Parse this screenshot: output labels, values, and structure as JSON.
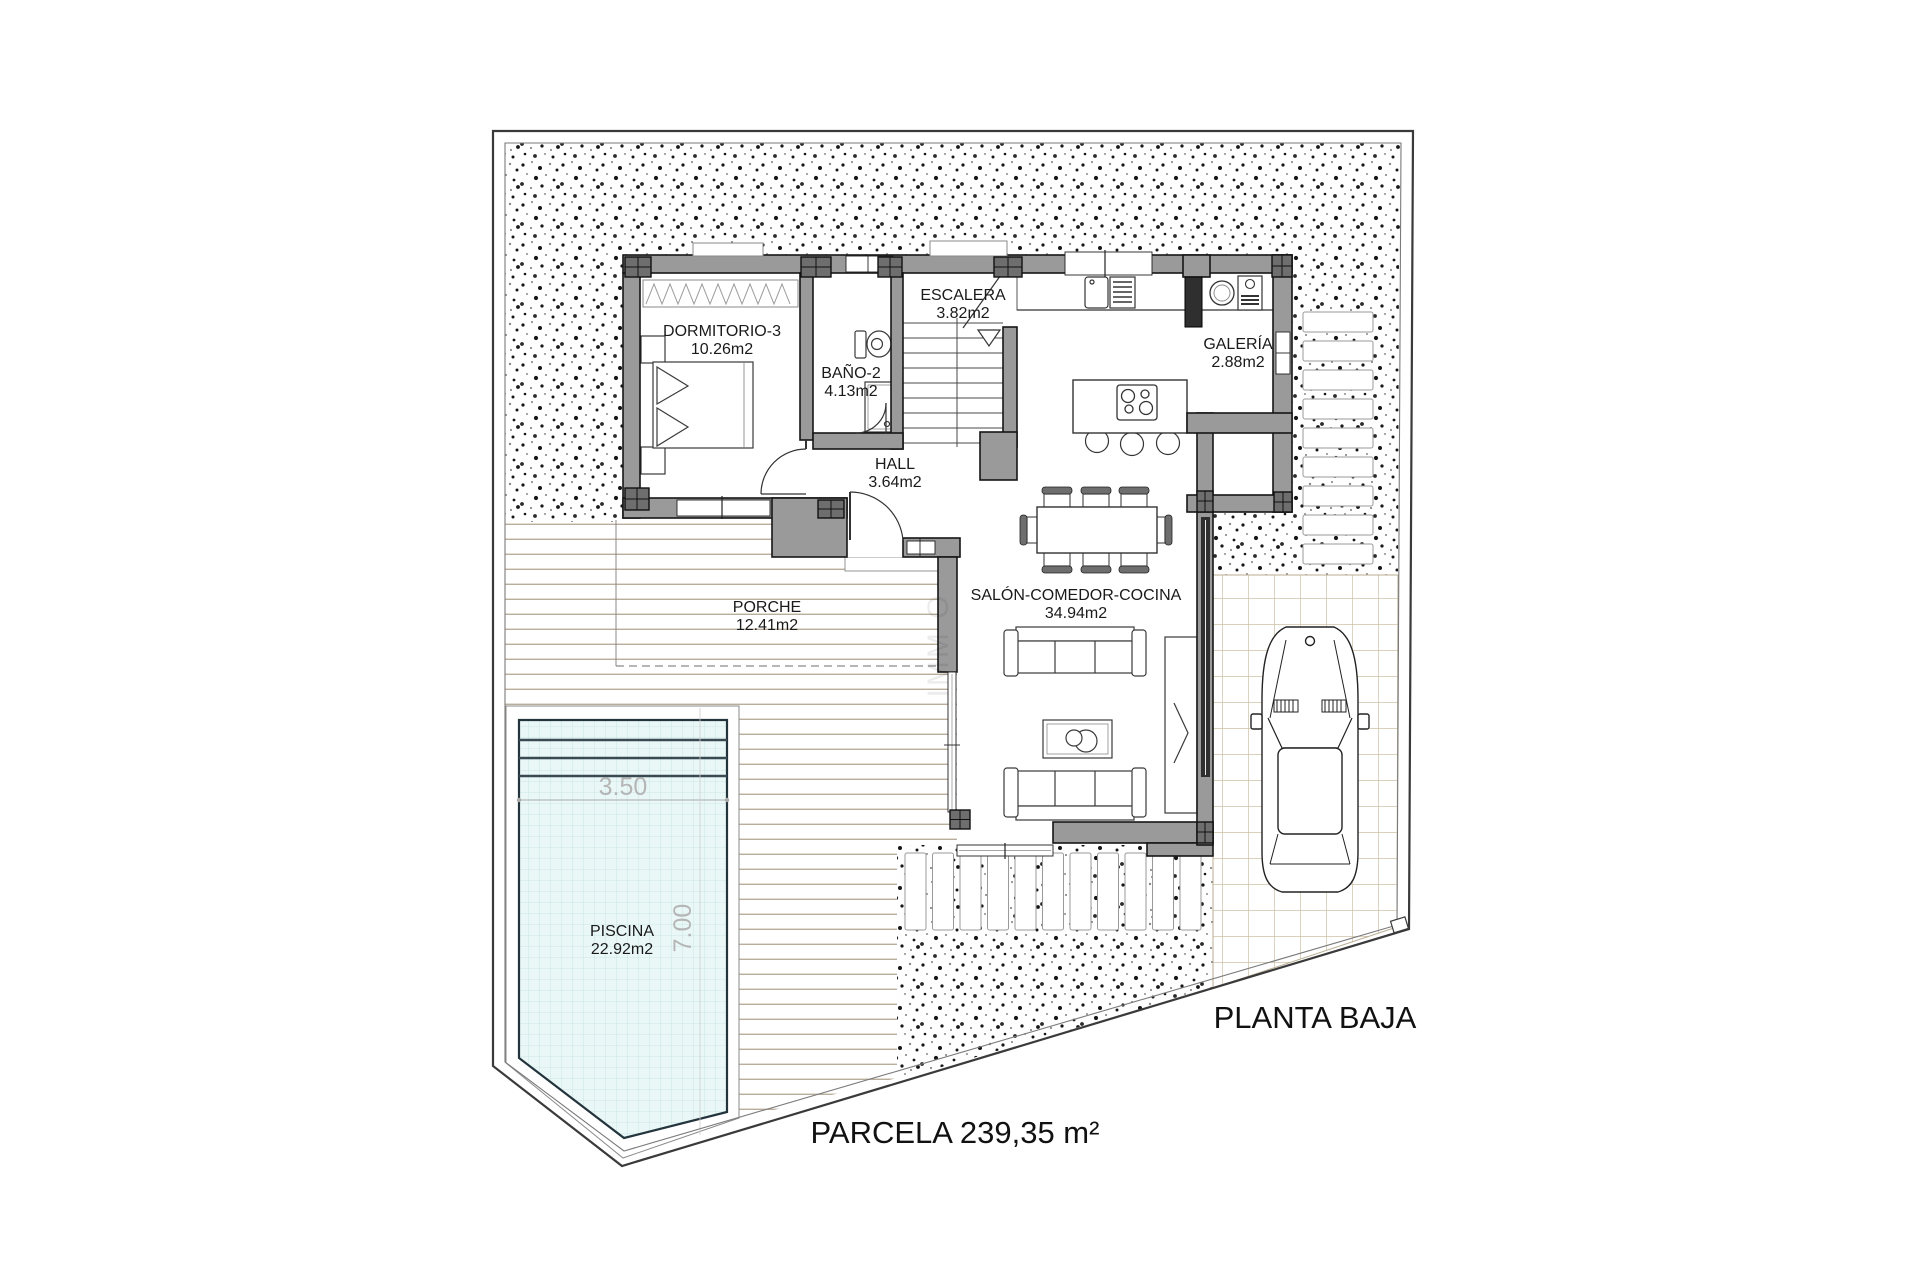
{
  "plan": {
    "title": "PLANTA BAJA",
    "parcela_label": "PARCELA 239,35 m²",
    "rooms": {
      "dormitorio": {
        "name": "DORMITORIO-3",
        "area": "10.26m2"
      },
      "bano": {
        "name": "BAÑO-2",
        "area": "4.13m2"
      },
      "escalera": {
        "name": "ESCALERA",
        "area": "3.82m2"
      },
      "galeria": {
        "name": "GALERÍA",
        "area": "2.88m2"
      },
      "hall": {
        "name": "HALL",
        "area": "3.64m2"
      },
      "salon": {
        "name": "SALÓN-COMEDOR-COCINA",
        "area": "34.94m2"
      },
      "porche": {
        "name": "PORCHE",
        "area": "12.41m2"
      },
      "piscina": {
        "name": "PISCINA",
        "area": "22.92m2"
      }
    },
    "pool": {
      "width_label": "3.50",
      "length_label": "7.00"
    },
    "watermark": "IMM O",
    "colors": {
      "wall": "#9a9a9a",
      "wall_dark": "#6e6e6e",
      "water": "#e9f6f6",
      "water_grid": "#c2e2e2",
      "deck_line": "#b9ae9b",
      "tile_line": "#cdc0a6",
      "dim_text": "#b5b5b5"
    }
  }
}
